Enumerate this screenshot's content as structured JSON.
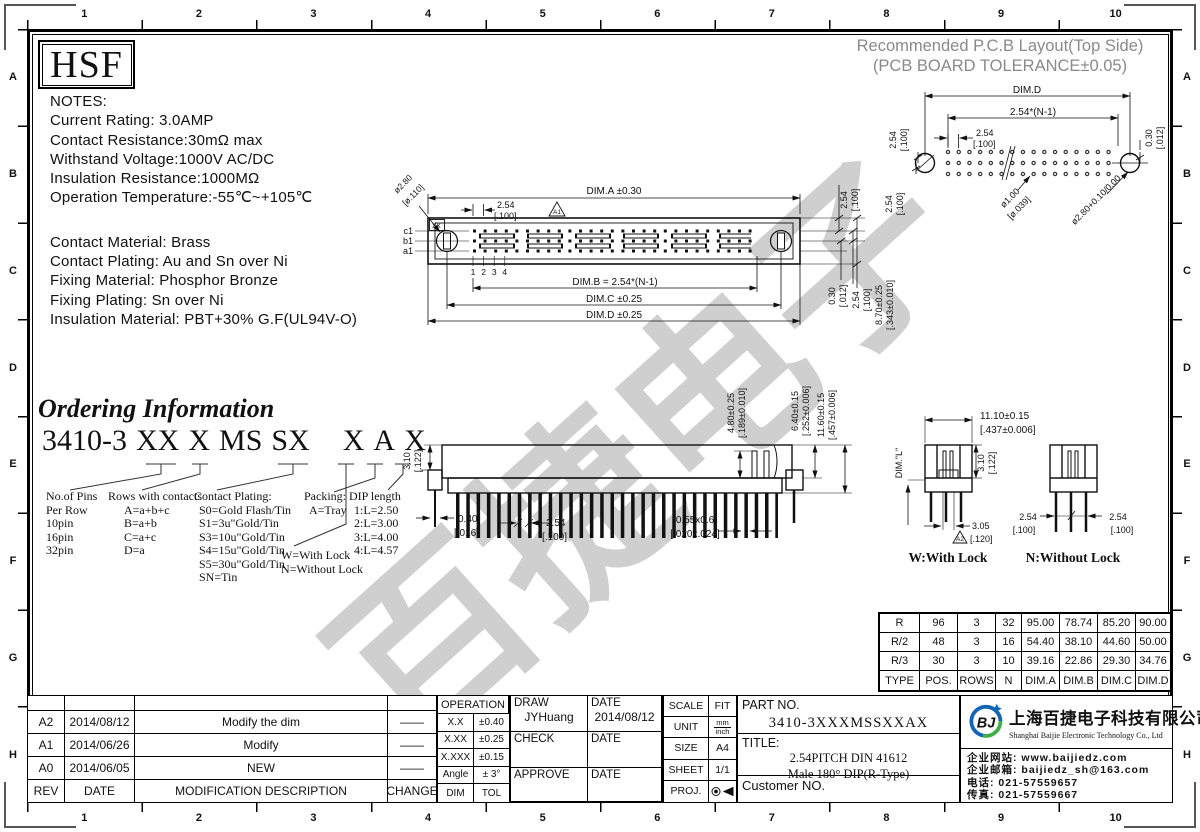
{
  "watermark": {
    "text": "百捷电子"
  },
  "brand": {
    "logo": "HSF"
  },
  "ruler": {
    "cols": [
      "1",
      "2",
      "3",
      "4",
      "5",
      "6",
      "7",
      "8",
      "9",
      "10"
    ],
    "rows": [
      "A",
      "B",
      "C",
      "D",
      "E",
      "F",
      "G",
      "H"
    ]
  },
  "notes": {
    "title": "NOTES:",
    "l1": "Current Rating: 3.0AMP",
    "l2": "Contact Resistance:30mΩ max",
    "l3": "Withstand Voltage:1000V AC/DC",
    "l4": "Insulation Resistance:1000MΩ",
    "l5": "Operation Temperature:-55℃~+105℃",
    "m1": "Contact Material: Brass",
    "m2": "Contact Plating: Au and Sn over Ni",
    "m3": "Fixing Material: Phosphor Bronze",
    "m4": "Fixing Plating: Sn over Ni",
    "m5": "Insulation Material: PBT+30% G.F(UL94V-O)"
  },
  "pcb": {
    "title1": "Recommended P.C.B Layout(Top Side)",
    "title2": "(PCB BOARD TOLERANCE±0.05)",
    "dim_d": "DIM.D",
    "pn": "2.54*(N-1)",
    "p": "2.54",
    "p_in": "[.100]",
    "vp1": "2.54",
    "vp1_in": "[.100]",
    "vp2": "2.54",
    "vp2_in": "[.100]",
    "edge": "0.30",
    "edge_in": "[.012]",
    "hole1": "ø1.00",
    "hole1_in": "[ø.039]",
    "hole2": "ø2.80+0.10/0.00",
    "hole2_in": "[ø.110+0.004/0.000]"
  },
  "tv": {
    "dim_a": "DIM.A ±0.30",
    "p": "2.54",
    "p_in": "[.100]",
    "rev": "A1",
    "xx": "XX",
    "hole": "ø2.80",
    "hole_in": "[ø.110]",
    "c1": "c1",
    "b1": "b1",
    "a1": "a1",
    "n1": "1",
    "n2": "2",
    "n3": "3",
    "n4": "4",
    "dim_b": "DIM.B = 2.54*(N-1)",
    "dim_c": "DIM.C ±0.25",
    "dim_d": "DIM.D ±0.25",
    "rp": "2.54",
    "rp_in": "[.100]",
    "re": "0.30",
    "re_in": "[.012]",
    "rp2": "2.54",
    "rp2_in": "[.100]",
    "rh": "8.70±0.25",
    "rh_in": "[.343±0.010]"
  },
  "sv": {
    "h": "3.10",
    "h_in": "[.122]",
    "p1": "0.40",
    "p1_in": "[.016]",
    "p2": "2.54",
    "p2_in": "[.100]",
    "p3": "0.55x0.6",
    "p3_in": "[.020x.024]",
    "v1": "4.80±0.25",
    "v1_in": "[.189±0.010]",
    "v2": "6.40±0.15",
    "v2_in": "[.252±0.006]",
    "v3": "11.60±0.15",
    "v3_in": "[.457±0.006]"
  },
  "ev": {
    "w": "11.10±0.15",
    "w_in": "[.437±0.006]",
    "diml": "DIM.\"L\"",
    "h": "3.10",
    "h_in": "[.122]",
    "lk": "3.05",
    "lk_in": "[.120]",
    "rev": "A2",
    "pl": "2.54",
    "pl_in": "[.100]",
    "pr": "2.54",
    "pr_in": "[.100]",
    "wl": "W:With Lock",
    "nl": "N:Without Lock"
  },
  "ordering": {
    "title": "Ordering Information",
    "seg1": "3410-3",
    "seg2": "XX",
    "seg3": "X",
    "seg4": "MS",
    "seg5": "SX",
    "seg6": "X",
    "seg7": "A",
    "seg8": "X",
    "c1h": "No.of Pins",
    "c1s": "Per Row",
    "c1i1": "10pin",
    "c1i2": "16pin",
    "c1i3": "32pin",
    "c2h": "Rows with contacts",
    "c2i1": "A=a+b+c",
    "c2i2": "B=a+b",
    "c2i3": "C=a+c",
    "c2i4": "D=a",
    "c3h": "Contact Plating:",
    "c3i1": "S0=Gold Flash/Tin",
    "c3i2": "S1=3u\"Gold/Tin",
    "c3i3": "S3=10u\"Gold/Tin",
    "c3i4": "S4=15u\"Gold/Tin",
    "c3i5": "S5=30u\"Gold/Tin",
    "c3i6": "SN=Tin",
    "lk1": "W=With Lock",
    "lk2": "N=Without Lock",
    "pkh": "Packing:",
    "pki": "A=Tray",
    "dph": "DIP length",
    "dp1": "1:L=2.50",
    "dp2": "2:L=3.00",
    "dp3": "3:L=4.00",
    "dp4": "4:L=4.57"
  },
  "spec": {
    "rows": [
      [
        "R",
        "96",
        "3",
        "32",
        "95.00",
        "78.74",
        "85.20",
        "90.00"
      ],
      [
        "R/2",
        "48",
        "3",
        "16",
        "54.40",
        "38.10",
        "44.60",
        "50.00"
      ],
      [
        "R/3",
        "30",
        "3",
        "10",
        "39.16",
        "22.86",
        "29.30",
        "34.76"
      ],
      [
        "TYPE",
        "POS.",
        "ROWS",
        "N",
        "DIM.A",
        "DIM.B",
        "DIM.C",
        "DIM.D"
      ]
    ]
  },
  "rev": {
    "rows": [
      {
        "rev": "A2",
        "date": "2014/08/12",
        "desc": "Modify the dim",
        "chg": "——"
      },
      {
        "rev": "A1",
        "date": "2014/06/26",
        "desc": "Modify",
        "chg": "——"
      },
      {
        "rev": "A0",
        "date": "2014/06/05",
        "desc": "NEW",
        "chg": "——"
      }
    ],
    "h": {
      "rev": "REV",
      "date": "DATE",
      "desc": "MODIFICATION DESCRIPTION",
      "chg": "CHANGE"
    }
  },
  "tol": {
    "h": "OPERATION",
    "r1a": "X.X",
    "r1b": "±0.40",
    "r2a": "X.XX",
    "r2b": "±0.25",
    "r3a": "X.XXX",
    "r3b": "±0.15",
    "r4a": "Angle",
    "r4b": "± 3°",
    "r5a": "DIM",
    "r5b": "TOL"
  },
  "sign": {
    "draw": "DRAW",
    "draw_name": "JYHuang",
    "d1": "DATE",
    "d1v": "2014/08/12",
    "check": "CHECK",
    "d2": "DATE",
    "approve": "APPROVE",
    "d3": "DATE"
  },
  "info": {
    "scale": "SCALE",
    "scale_v": "FIT",
    "unit": "UNIT",
    "unit_top": "mm",
    "unit_bot": "inch",
    "size": "SIZE",
    "size_v": "A4",
    "sheet": "SHEET",
    "sheet_v": "1/1",
    "proj": "PROJ."
  },
  "part": {
    "no_label": "PART NO.",
    "no": "3410-3XXXMSSXXAX",
    "title_label": "TITLE:",
    "t1": "2.54PITCH DIN 41612",
    "t2": "Male 180° DIP(R-Type)",
    "customer": "Customer NO."
  },
  "company": {
    "cn": "上海百捷电子科技有限公司",
    "en": "Shanghai Baijie Electronic Technology Co., Ltd",
    "logo": "BJ",
    "web": "企业网站: www.baijiedz.com",
    "mail": "企业邮箱: baijiedz_sh@163.com",
    "tel": "电话: 021-57559657",
    "fax": "传真: 021-57559667",
    "blue": "#1266b3",
    "green": "#3fae49"
  }
}
